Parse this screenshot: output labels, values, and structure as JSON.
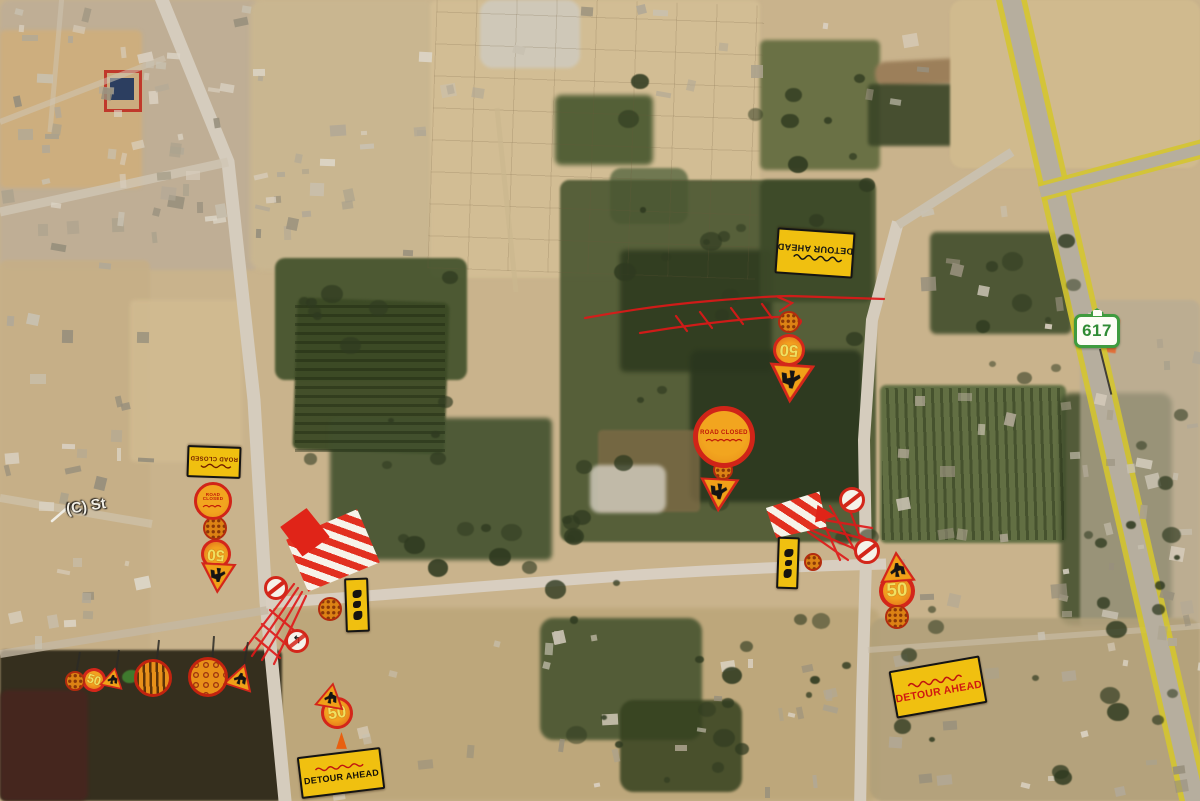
{
  "app": {
    "description": "Satellite map with road-work detour signage overlay"
  },
  "map_labels": {
    "street": "(C) St",
    "route_shield": "617"
  },
  "signs": {
    "detour_ahead": "DETOUR AHEAD",
    "detour_ahead_arabic": "تحويلة الطريق",
    "road_closed": "ROAD CLOSED",
    "road_closed_arabic": "الطريق مغلق",
    "speed_limit": "50"
  },
  "icons": {
    "no_left_turn_arrow": "↰",
    "no_entry_icon": "red circle with diagonal bar",
    "worker_triangle_icon": "road-works warning triangle",
    "dotted_disc_icon": "orange patterned roadwork disc",
    "barrier_icon": "red-white striped barrier",
    "cone_icon": "traffic cone",
    "route_shield_icon": "green route shield"
  },
  "colors": {
    "sign_yellow": "#f0c010",
    "sign_red": "#d3261a",
    "sign_orange": "#f0a018",
    "shield_green": "#3f9b3f",
    "scribble_red": "#e01818"
  }
}
